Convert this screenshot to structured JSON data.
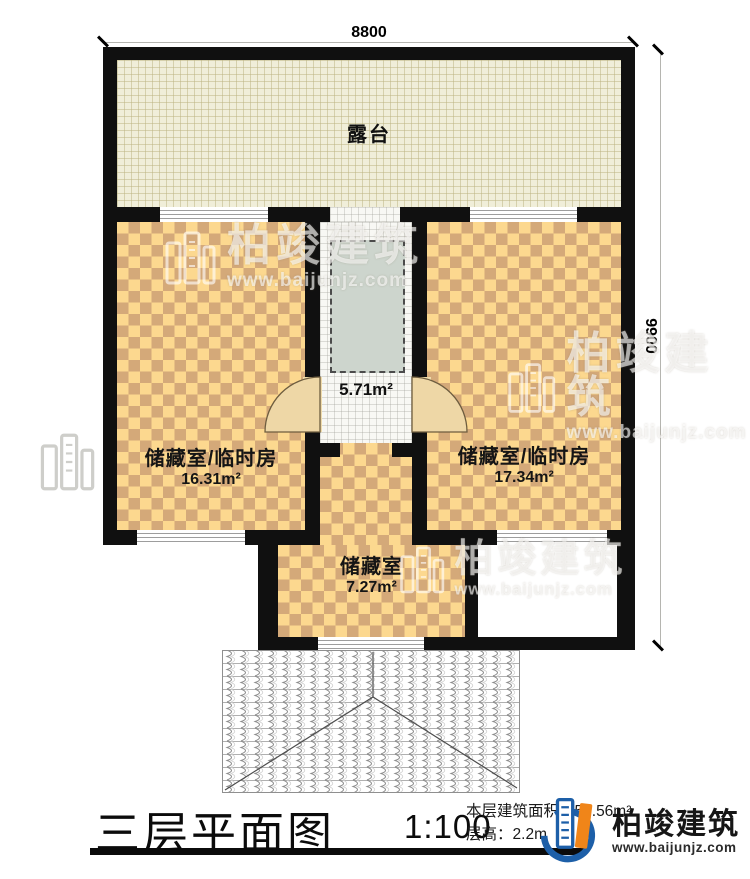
{
  "dimensions": {
    "top": "8800",
    "right": "9900"
  },
  "rooms": {
    "terrace": {
      "label": "露台"
    },
    "hall": {
      "area": "5.71m²"
    },
    "left_room": {
      "label": "储藏室/临时房",
      "area": "16.31m²"
    },
    "right_room": {
      "label": "储藏室/临时房",
      "area": "17.34m²"
    },
    "storage": {
      "label": "储藏室",
      "area": "7.27m²"
    }
  },
  "title_block": {
    "title": "三层平面图",
    "scale": "1:100",
    "area_prefix": "本层建筑面积：",
    "area_value": "57.56m²",
    "height_prefix": "层高：",
    "height_value": "2.2m"
  },
  "logo": {
    "name": "柏竣建筑",
    "url": "www.baijunjz.com"
  },
  "watermark": {
    "name": "柏竣建筑",
    "url": "www.baijunjz.com"
  },
  "colors": {
    "wall": "#101010",
    "checker_light": "#fcd88f",
    "checker_dark": "#d4a979",
    "terrace": "#f0eed9",
    "skylight": "#cdd5cd",
    "logo_blue": "#1d5fa8",
    "logo_orange": "#f08519"
  }
}
